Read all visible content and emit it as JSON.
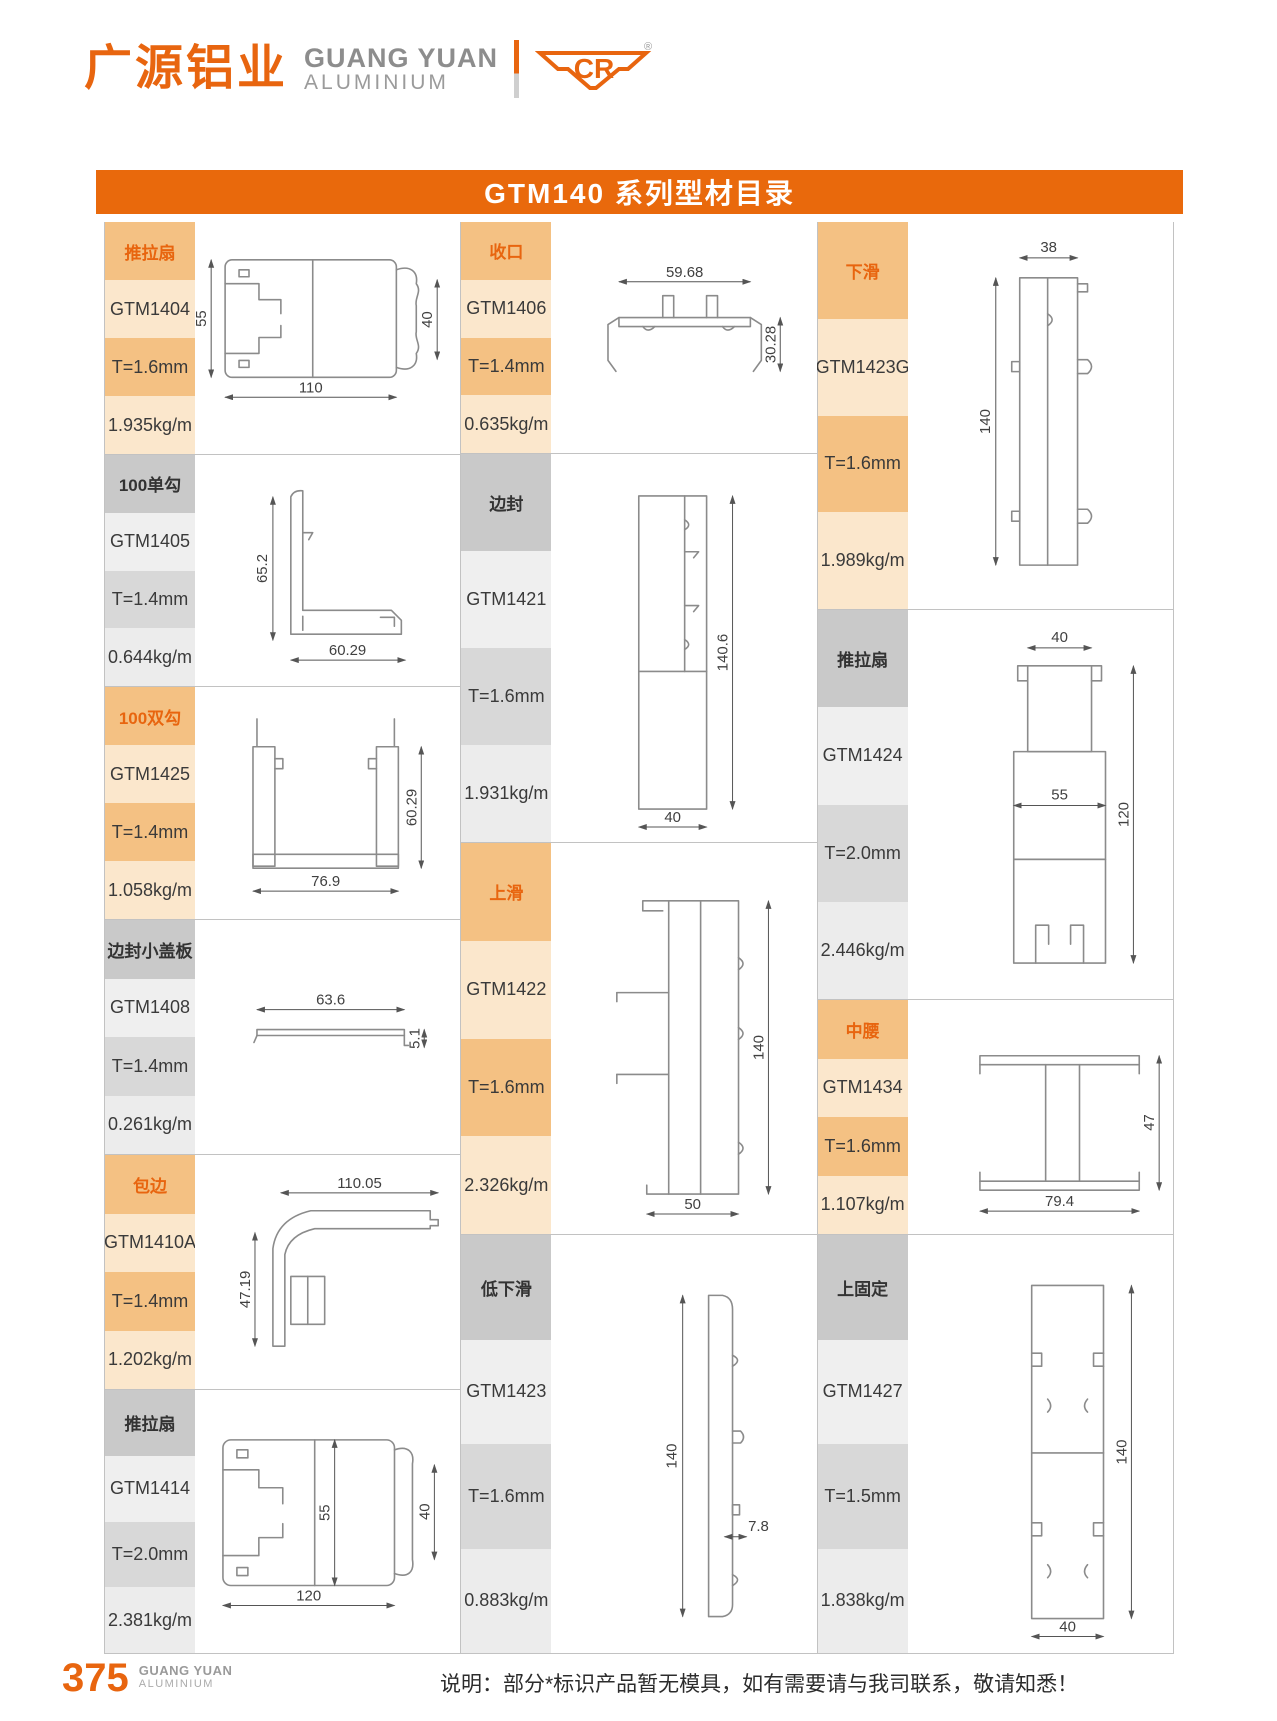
{
  "brand": {
    "logo_cn": "广源铝业",
    "logo_en1": "GUANG YUAN",
    "logo_en2": "ALUMINIUM",
    "logo_mark": "CR",
    "registered": "®"
  },
  "header": {
    "title": "GTM140 系列型材目录"
  },
  "footer": {
    "page_number": "375",
    "brand_en1": "GUANG YUAN",
    "brand_en2": "ALUMINIUM",
    "note": "说明：部分*标识产品暂无模具，如有需要请与我司联系，敬请知悉！"
  },
  "colors": {
    "brand_orange": "#E8650F",
    "tan_cell": "#F4C183",
    "cream_cell": "#FBE7CC",
    "gray_header_cell": "#C9C9C9",
    "gray_mid_cell": "#D8D8D8",
    "gray_light_cell": "#EFEFEF"
  },
  "cols": [
    {
      "groups": [
        {
          "category": "推拉扇",
          "model": "GTM1404",
          "thickness": "T=1.6mm",
          "weight": "1.935kg/m",
          "dims": [
            "55",
            "110",
            "40"
          ]
        },
        {
          "category": "100单勾",
          "model": "GTM1405",
          "thickness": "T=1.4mm",
          "weight": "0.644kg/m",
          "dims": [
            "65.2",
            "60.29"
          ]
        },
        {
          "category": "100双勾",
          "model": "GTM1425",
          "thickness": "T=1.4mm",
          "weight": "1.058kg/m",
          "dims": [
            "76.9",
            "60.29"
          ]
        },
        {
          "category": "边封小盖板",
          "model": "GTM1408",
          "thickness": "T=1.4mm",
          "weight": "0.261kg/m",
          "dims": [
            "63.6",
            "5.1"
          ]
        },
        {
          "category": "包边",
          "model": "GTM1410A",
          "thickness": "T=1.4mm",
          "weight": "1.202kg/m",
          "dims": [
            "110.05",
            "47.19"
          ]
        },
        {
          "category": "推拉扇",
          "model": "GTM1414",
          "thickness": "T=2.0mm",
          "weight": "2.381kg/m",
          "dims": [
            "55",
            "120",
            "40"
          ]
        }
      ]
    },
    {
      "groups": [
        {
          "category": "收口",
          "model": "GTM1406",
          "thickness": "T=1.4mm",
          "weight": "0.635kg/m",
          "dims": [
            "59.68",
            "30.28"
          ]
        },
        {
          "category": "边封",
          "model": "GTM1421",
          "thickness": "T=1.6mm",
          "weight": "1.931kg/m",
          "dims": [
            "140.6",
            "40"
          ]
        },
        {
          "category": "上滑",
          "model": "GTM1422",
          "thickness": "T=1.6mm",
          "weight": "2.326kg/m",
          "dims": [
            "140",
            "50"
          ]
        },
        {
          "category": "低下滑",
          "model": "GTM1423",
          "thickness": "T=1.6mm",
          "weight": "0.883kg/m",
          "dims": [
            "140",
            "7.8"
          ]
        }
      ]
    },
    {
      "groups": [
        {
          "category": "下滑",
          "model": "GTM1423G",
          "thickness": "T=1.6mm",
          "weight": "1.989kg/m",
          "dims": [
            "38",
            "140"
          ]
        },
        {
          "category": "推拉扇",
          "model": "GTM1424",
          "thickness": "T=2.0mm",
          "weight": "2.446kg/m",
          "dims": [
            "40",
            "55",
            "120"
          ]
        },
        {
          "category": "中腰",
          "model": "GTM1434",
          "thickness": "T=1.6mm",
          "weight": "1.107kg/m",
          "dims": [
            "79.4",
            "47"
          ]
        },
        {
          "category": "上固定",
          "model": "GTM1427",
          "thickness": "T=1.5mm",
          "weight": "1.838kg/m",
          "dims": [
            "140",
            "40"
          ]
        }
      ]
    }
  ]
}
